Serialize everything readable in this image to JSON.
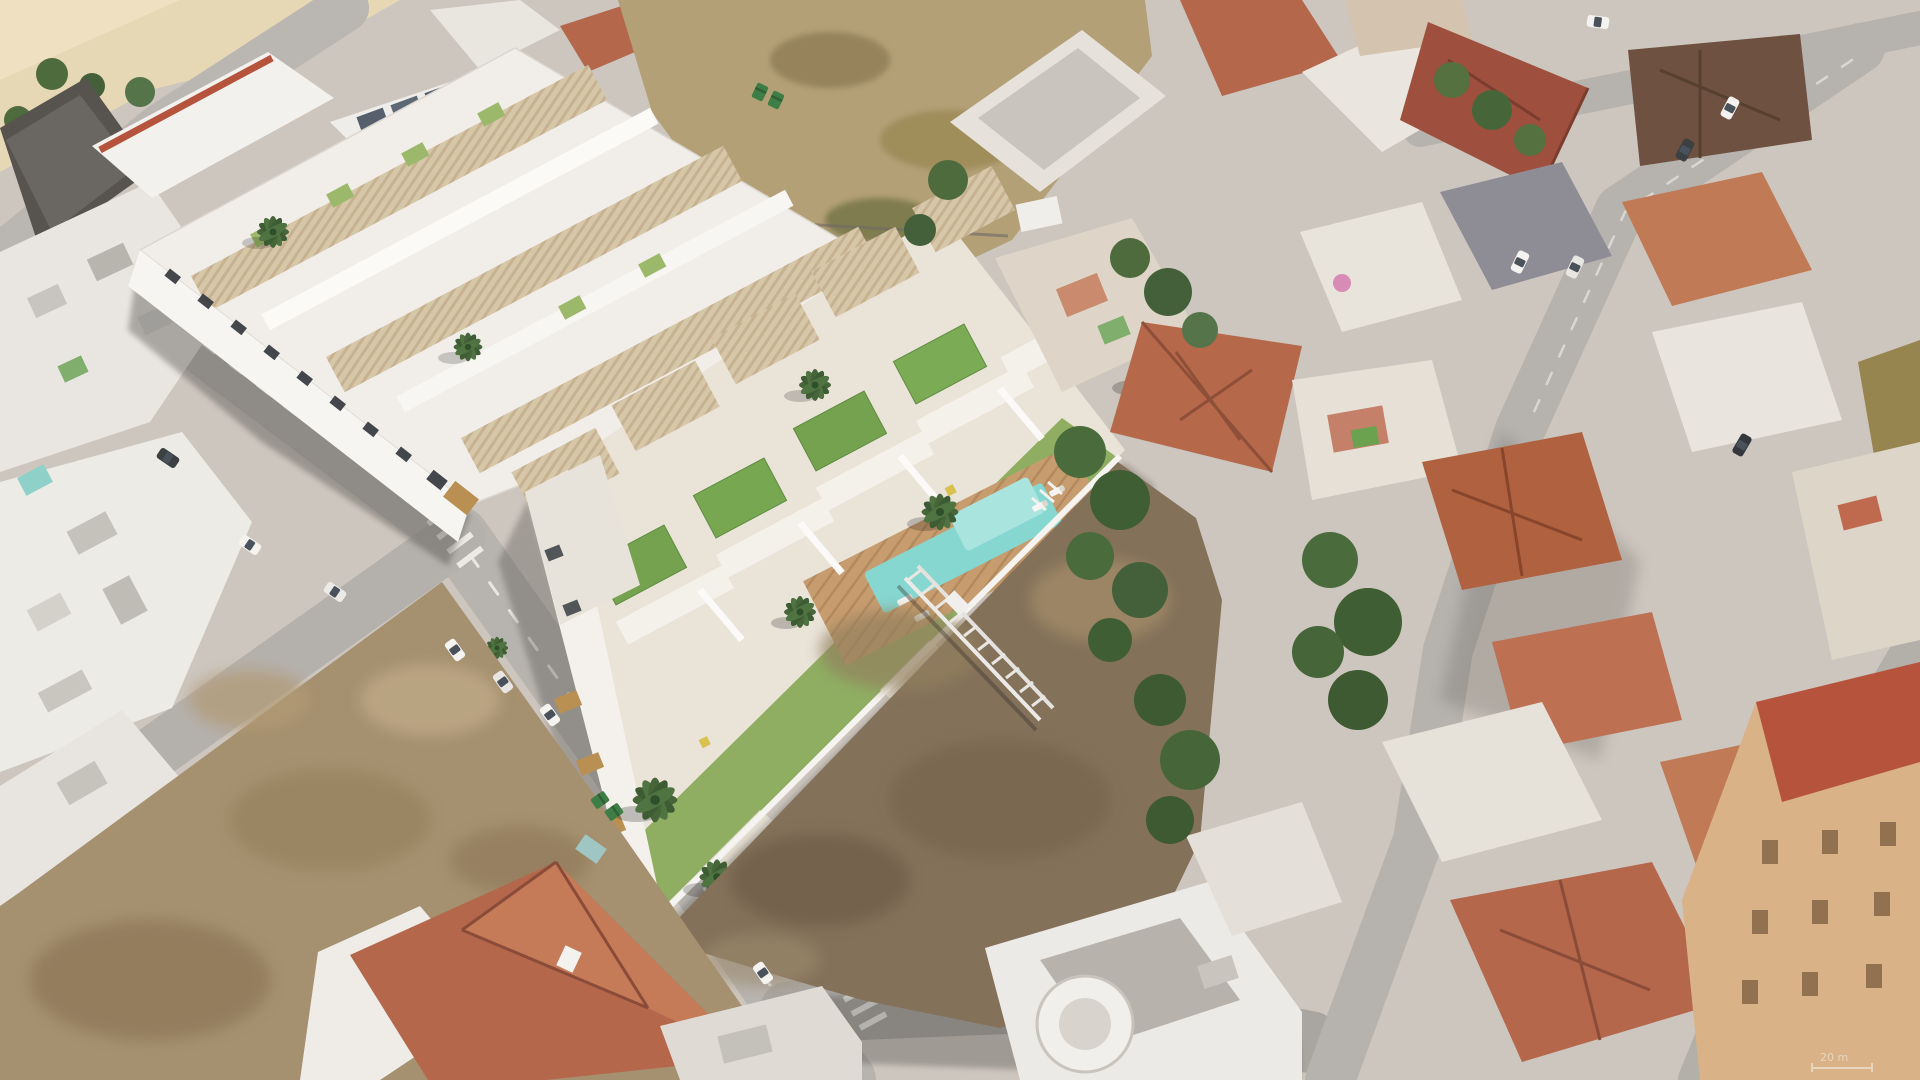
{
  "meta": {
    "type": "aerial-3d-architectural-render",
    "description": "Bird's-eye 3D render of a new whitewashed townhouse development with slatted pergola roofs, artificial-grass rooftop terraces, a wooden pool deck and turquoise pool, composited into a real Spanish coastal town with terracotta-roofed houses, vacant dirt lots, diagonal streets, parked cars and palm trees.",
    "landmarks": [
      "beach-sand-corner",
      "white-industrial-building",
      "existing-townhouse-complex",
      "new-development-block",
      "rooftop-green-terraces",
      "pergola-roofs",
      "swimming-pool",
      "pool-deck",
      "garden-lawn",
      "palm-trees",
      "vacant-dirt-lot-top",
      "vacant-dirt-lot-center",
      "vacant-dirt-lot-foreground",
      "steel-truss-on-ground",
      "terracotta-roof-neighborhood",
      "tower-building-bottom-right",
      "street-grid",
      "crosswalks",
      "parked-cars",
      "recycling-bins"
    ]
  },
  "overlay": {
    "scale_label": "20 m"
  },
  "palette": {
    "ground_concrete": "#cdc6be",
    "road": "#b7b3ae",
    "road_shadow": "#55524f",
    "beach_sand": "#e7d8b5",
    "dry_lot": "#b3a077",
    "dirt_light": "#a5906f",
    "dirt_dark": "#84715a",
    "render_white": "#f2efea",
    "pergola_tan": "#d7c7a9",
    "louver_wood": "#c29a5e",
    "grass_roof": "#74a24f",
    "lawn": "#8fae62",
    "pool_water": "#85d7d0",
    "deck_wood": "#c79d6f",
    "terracotta": "#b4674b",
    "brown_roof": "#6e5140",
    "tree_green": "#46663a",
    "car_white": "#f4f3f0"
  }
}
